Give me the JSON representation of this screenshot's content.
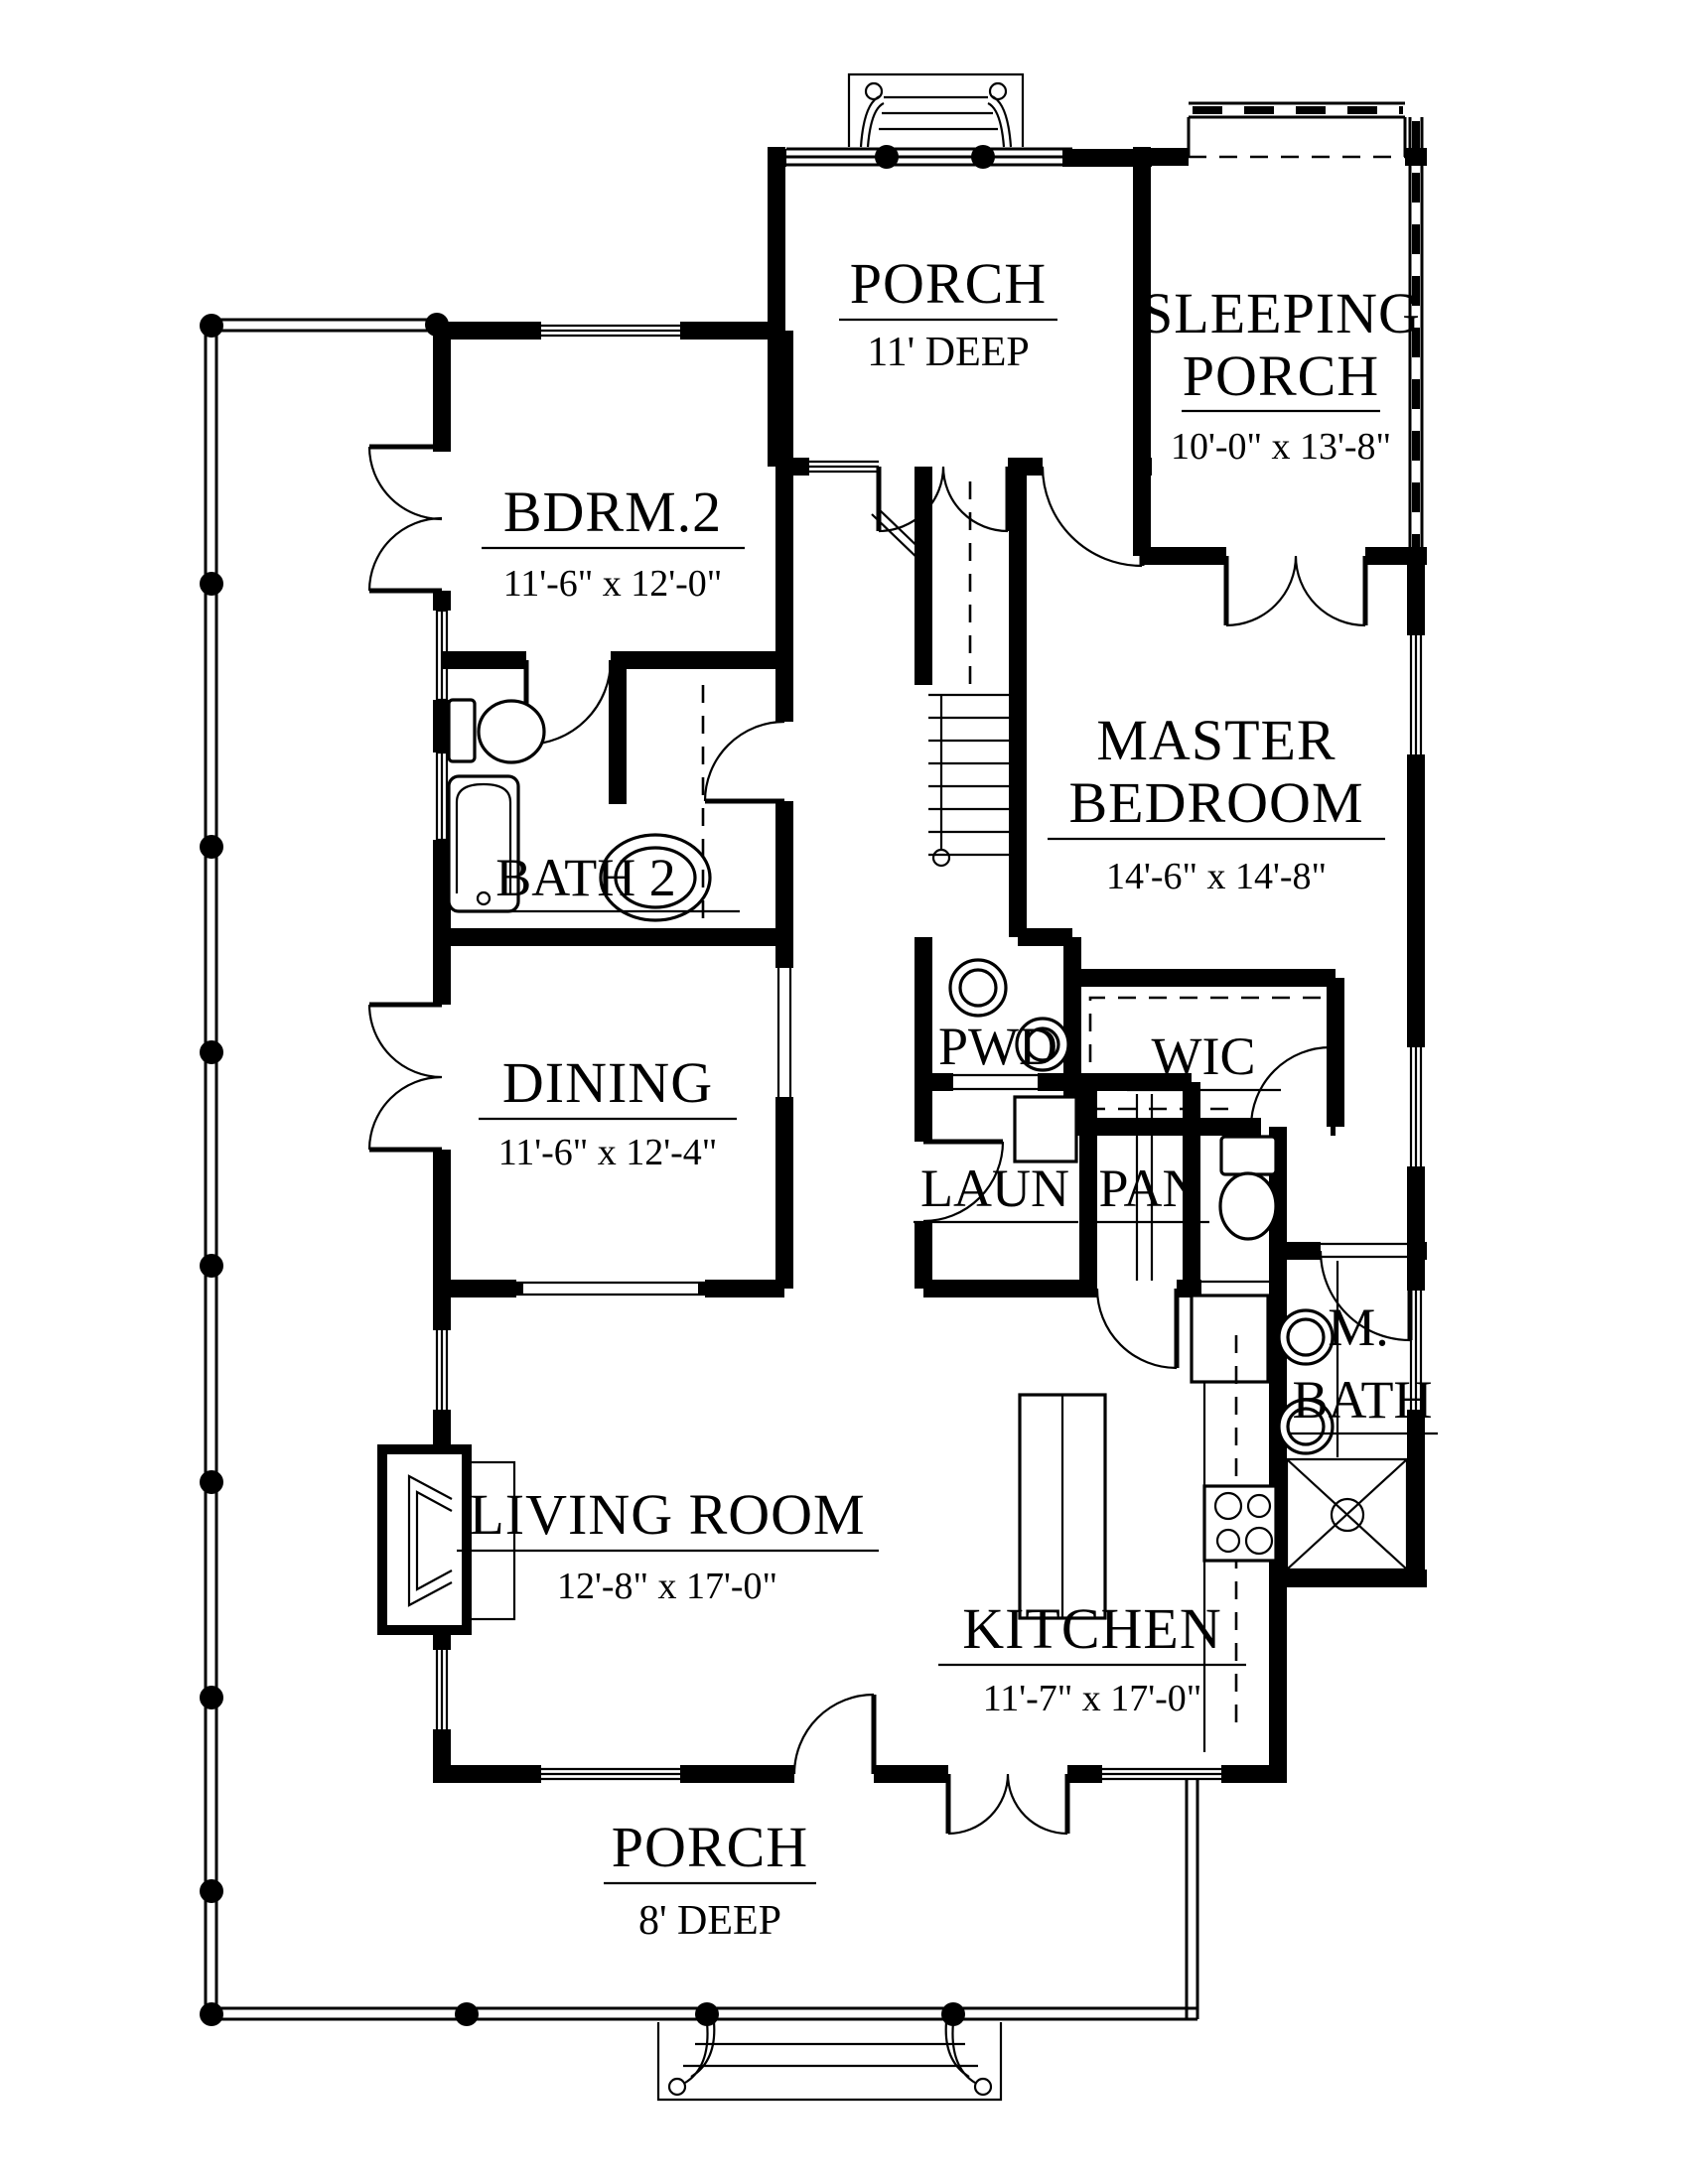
{
  "drawing": {
    "type": "first-floor-plan",
    "paper_color": "#ffffff",
    "ink_color": "#000000"
  },
  "rooms": {
    "porch_top": {
      "name": "PORCH",
      "dim": "11' DEEP"
    },
    "sleeping_porch": {
      "line1": "SLEEPING",
      "line2": "PORCH",
      "dim": "10'-0\" x 13'-8\""
    },
    "bdrm2": {
      "name": "BDRM.2",
      "dim": "11'-6\" x 12'-0\""
    },
    "master": {
      "line1": "MASTER",
      "line2": "BEDROOM",
      "dim": "14'-6\" x 14'-8\""
    },
    "bath2": {
      "name": "BATH 2"
    },
    "dining": {
      "name": "DINING",
      "dim": "11'-6\" x 12'-4\""
    },
    "pwd": {
      "name": "PWD"
    },
    "wic": {
      "name": "WIC"
    },
    "laundry": {
      "name": "LAUN"
    },
    "pantry": {
      "name": "PAN"
    },
    "living": {
      "name": "LIVING ROOM",
      "dim": "12'-8\" x 17'-0\""
    },
    "kitchen": {
      "name": "KITCHEN",
      "dim": "11'-7\" x 17'-0\""
    },
    "master_bath": {
      "line1": "M.",
      "line2": "BATH"
    },
    "porch_bottom": {
      "name": "PORCH",
      "dim": "8' DEEP"
    }
  }
}
